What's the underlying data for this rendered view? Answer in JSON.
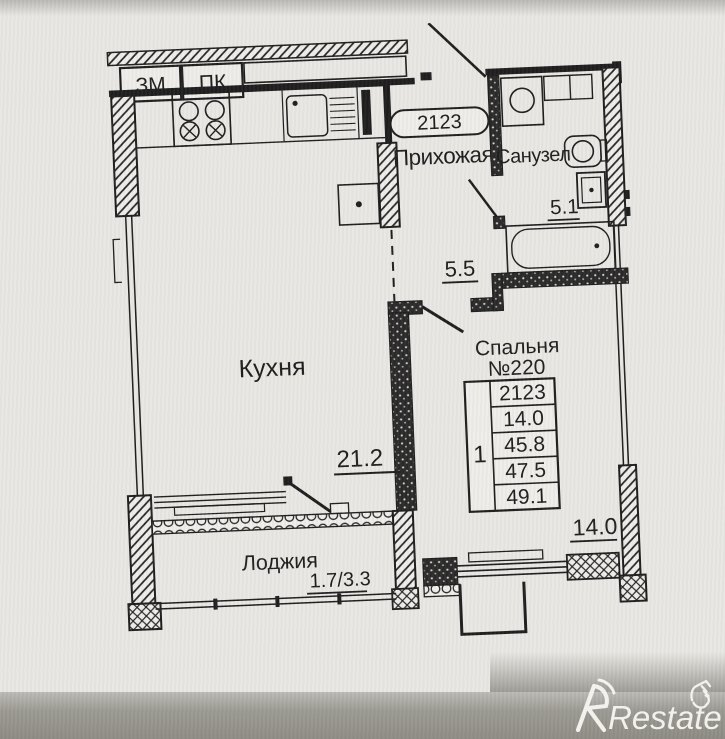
{
  "photo": {
    "brand_watermark": "Restate",
    "paper_color": "#e8e7e3",
    "ink_color": "#1c1c1c",
    "bottom_band_color": "#98968f",
    "watermark_color": "#f7f6f2"
  },
  "corridor": {
    "elevator_shaft_label": "ЗМ",
    "staircase_label": "ПК"
  },
  "apartment": {
    "number_tag": "2123",
    "rooms": {
      "hallway": {
        "name": "Прихожая",
        "area": "5.5"
      },
      "bathroom": {
        "name": "Санузел",
        "area": "5.1"
      },
      "kitchen": {
        "name": "Кухня",
        "area": "21.2"
      },
      "bedroom": {
        "name": "Спальня",
        "number": "№220",
        "area": "14.0"
      },
      "loggia": {
        "name": "Лоджия",
        "area": "1.7/3.3"
      }
    },
    "info_table": {
      "rooms_count": "1",
      "rows": [
        "2123",
        "14.0",
        "45.8",
        "47.5",
        "49.1"
      ]
    }
  }
}
